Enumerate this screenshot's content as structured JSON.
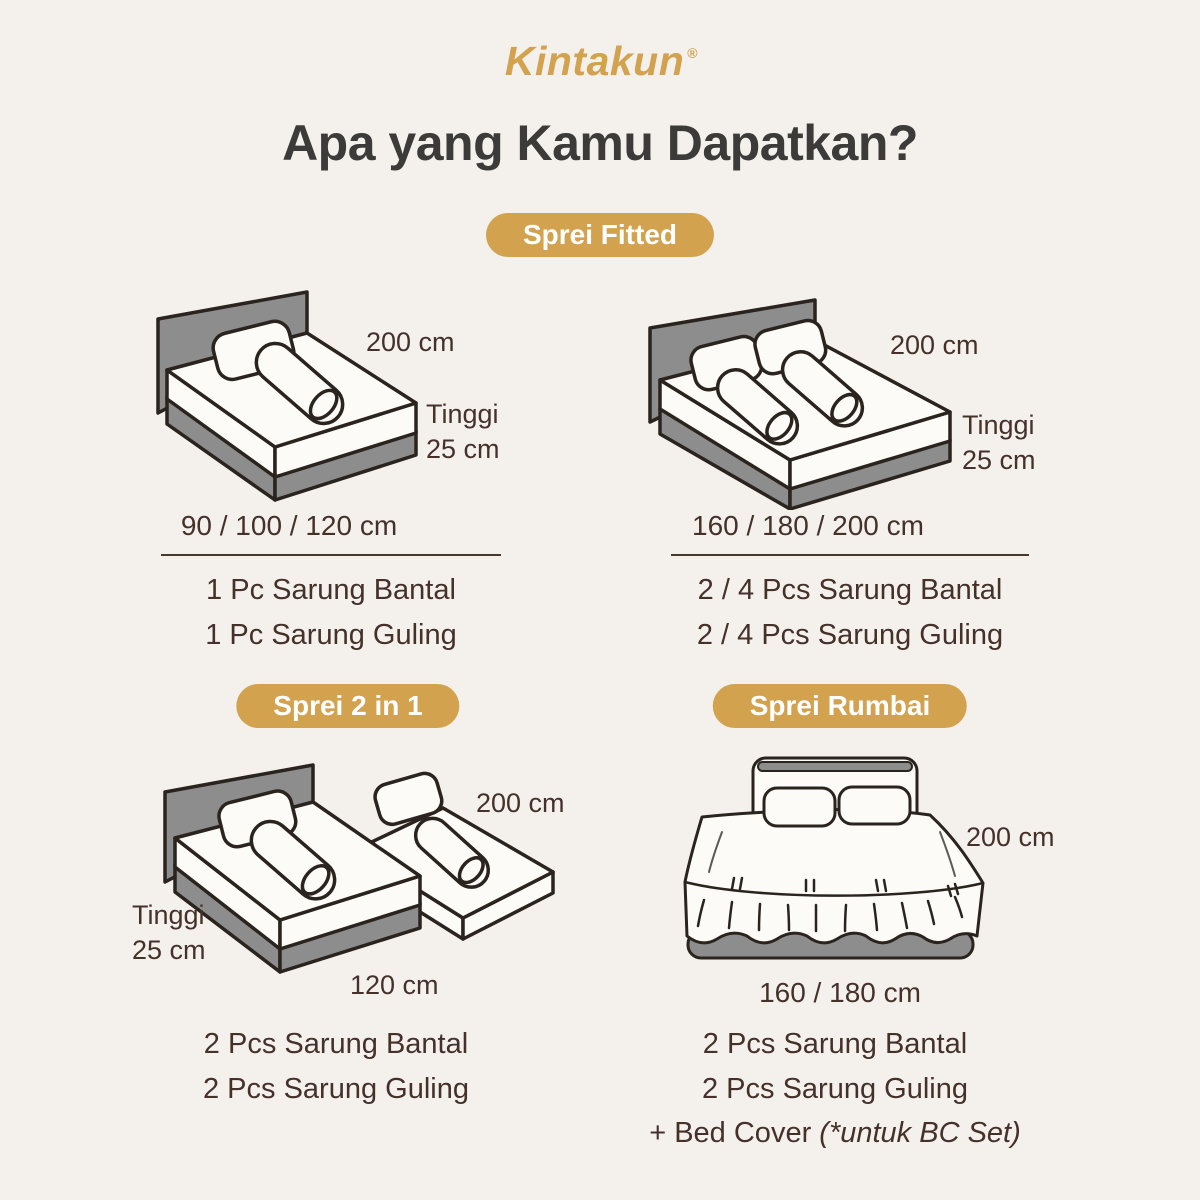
{
  "header": {
    "logo_text": "Kintakun",
    "registered_mark": "®",
    "title": "Apa yang Kamu Dapatkan?"
  },
  "colors": {
    "background": "#F4F1ED",
    "gold": "#D2A24E",
    "badge_text": "#FFFFFF",
    "title_text": "#3D3B3A",
    "body_text": "#45312A",
    "illustration_gray": "#8D8D8D",
    "illustration_outline": "#2A231E"
  },
  "sections": {
    "fitted": {
      "badge_label": "Sprei Fitted",
      "left": {
        "label_width": "200 cm",
        "label_height_line1": "Tinggi",
        "label_height_line2": "25 cm",
        "sizes": "90 / 100 / 120 cm",
        "items": [
          "1 Pc Sarung Bantal",
          "1 Pc Sarung Guling"
        ]
      },
      "right": {
        "label_width": "200 cm",
        "label_height_line1": "Tinggi",
        "label_height_line2": "25 cm",
        "sizes": "160 / 180 / 200 cm",
        "items": [
          "2 / 4 Pcs Sarung Bantal",
          "2 / 4 Pcs Sarung Guling"
        ]
      }
    },
    "two_in_one": {
      "badge_label": "Sprei 2 in 1",
      "label_width": "200 cm",
      "label_height_line1": "Tinggi",
      "label_height_line2": "25 cm",
      "label_bottom": "120 cm",
      "items": [
        "2 Pcs Sarung Bantal",
        "2 Pcs Sarung Guling"
      ]
    },
    "rumbai": {
      "badge_label": "Sprei Rumbai",
      "label_width": "200 cm",
      "label_bottom": "160 / 180 cm",
      "items": [
        "2 Pcs Sarung Bantal",
        "2 Pcs Sarung Guling"
      ],
      "bed_cover_prefix": "+ Bed Cover ",
      "bed_cover_note": "(*untuk BC Set)"
    }
  }
}
